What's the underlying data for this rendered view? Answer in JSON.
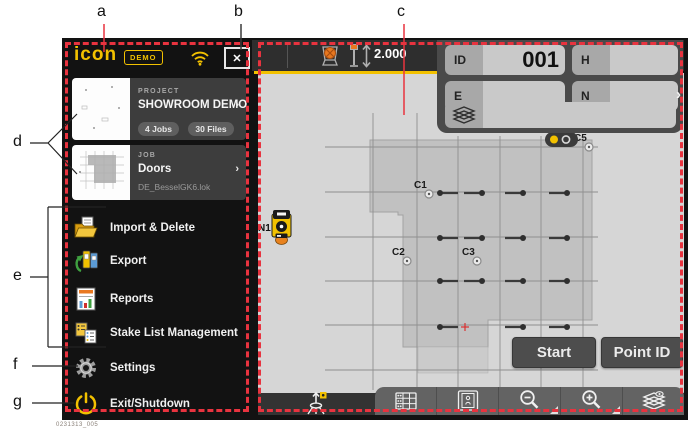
{
  "figure_number": "0231313_005",
  "annotations": {
    "a": "a",
    "b": "b",
    "c": "c",
    "d": "d",
    "e": "e",
    "f": "f",
    "g": "g"
  },
  "sidebar": {
    "logo": "icon",
    "demo_badge": "DEMO",
    "close_glyph": "✕",
    "project": {
      "kicker": "PROJECT",
      "name": "SHOWROOM DEMO",
      "chevron": "›",
      "badges": [
        "4 Jobs",
        "30 Files"
      ]
    },
    "job": {
      "kicker": "JOB",
      "name": "Doors",
      "chevron": "›",
      "file_name": "DE_BesselGK6.lok"
    },
    "menu": [
      {
        "label": "Import & Delete"
      },
      {
        "label": "Export"
      },
      {
        "label": "Reports"
      },
      {
        "label": "Stake List Management"
      },
      {
        "label": "Settings"
      },
      {
        "label": "Exit/Shutdown"
      }
    ]
  },
  "topbar": {
    "pole_height": "2.000"
  },
  "panel": {
    "fields": [
      {
        "label": "ID",
        "value": "001"
      },
      {
        "label": "H",
        "value": ""
      },
      {
        "label": "E",
        "value": ""
      },
      {
        "label": "N",
        "value": ""
      }
    ],
    "chevron": "›"
  },
  "map": {
    "buttons": {
      "start": "Start",
      "point_id": "Point ID"
    },
    "station_label": "N1",
    "grid": {
      "vx": [
        115,
        159,
        200,
        242,
        283,
        325
      ],
      "v_top": [
        40,
        40,
        63,
        63,
        63,
        63
      ],
      "v_bottom": 317,
      "hy": [
        74,
        119,
        164,
        208,
        252,
        297
      ],
      "h_x1": 67,
      "h_x2": 340
    },
    "outline": [
      [
        112,
        67
      ],
      [
        334,
        67
      ],
      [
        334,
        247
      ],
      [
        230,
        247
      ],
      [
        230,
        274
      ],
      [
        145,
        274
      ],
      [
        145,
        142
      ],
      [
        140,
        142
      ],
      [
        140,
        139
      ],
      [
        112,
        139
      ]
    ],
    "sub_area": {
      "x": 160,
      "y": 274,
      "w": 70,
      "h": 26
    },
    "doors": [
      {
        "x": 182,
        "y": 120,
        "dir": "r"
      },
      {
        "x": 224,
        "y": 120,
        "dir": "l"
      },
      {
        "x": 265,
        "y": 120,
        "dir": "l"
      },
      {
        "x": 309,
        "y": 120,
        "dir": "l"
      },
      {
        "x": 182,
        "y": 165,
        "dir": "r"
      },
      {
        "x": 224,
        "y": 165,
        "dir": "l"
      },
      {
        "x": 265,
        "y": 165,
        "dir": "l"
      },
      {
        "x": 309,
        "y": 165,
        "dir": "l"
      },
      {
        "x": 182,
        "y": 208,
        "dir": "r"
      },
      {
        "x": 224,
        "y": 208,
        "dir": "l"
      },
      {
        "x": 265,
        "y": 208,
        "dir": "l"
      },
      {
        "x": 309,
        "y": 208,
        "dir": "l"
      },
      {
        "x": 182,
        "y": 254,
        "dir": "r"
      },
      {
        "x": 265,
        "y": 254,
        "dir": "l"
      },
      {
        "x": 309,
        "y": 254,
        "dir": "l"
      }
    ],
    "red_cross": {
      "x": 207,
      "y": 254
    },
    "points": [
      {
        "id": "C1",
        "x": 171,
        "y": 121
      },
      {
        "id": "C2",
        "x": 149,
        "y": 188
      },
      {
        "id": "C3",
        "x": 219,
        "y": 188
      },
      {
        "id": "C5",
        "x": 331,
        "y": 74
      }
    ],
    "station": {
      "x": 14,
      "y": 137
    },
    "status_pill": {
      "x": 287,
      "y": 59,
      "w": 33,
      "h": 15
    }
  },
  "colors": {
    "accent_yellow": "#f2c100",
    "callout_red": "#e8333f",
    "map_bg": "#d6d6d6",
    "footprint": "#c1c1c1",
    "panel_bg": "#4a4a4a"
  }
}
